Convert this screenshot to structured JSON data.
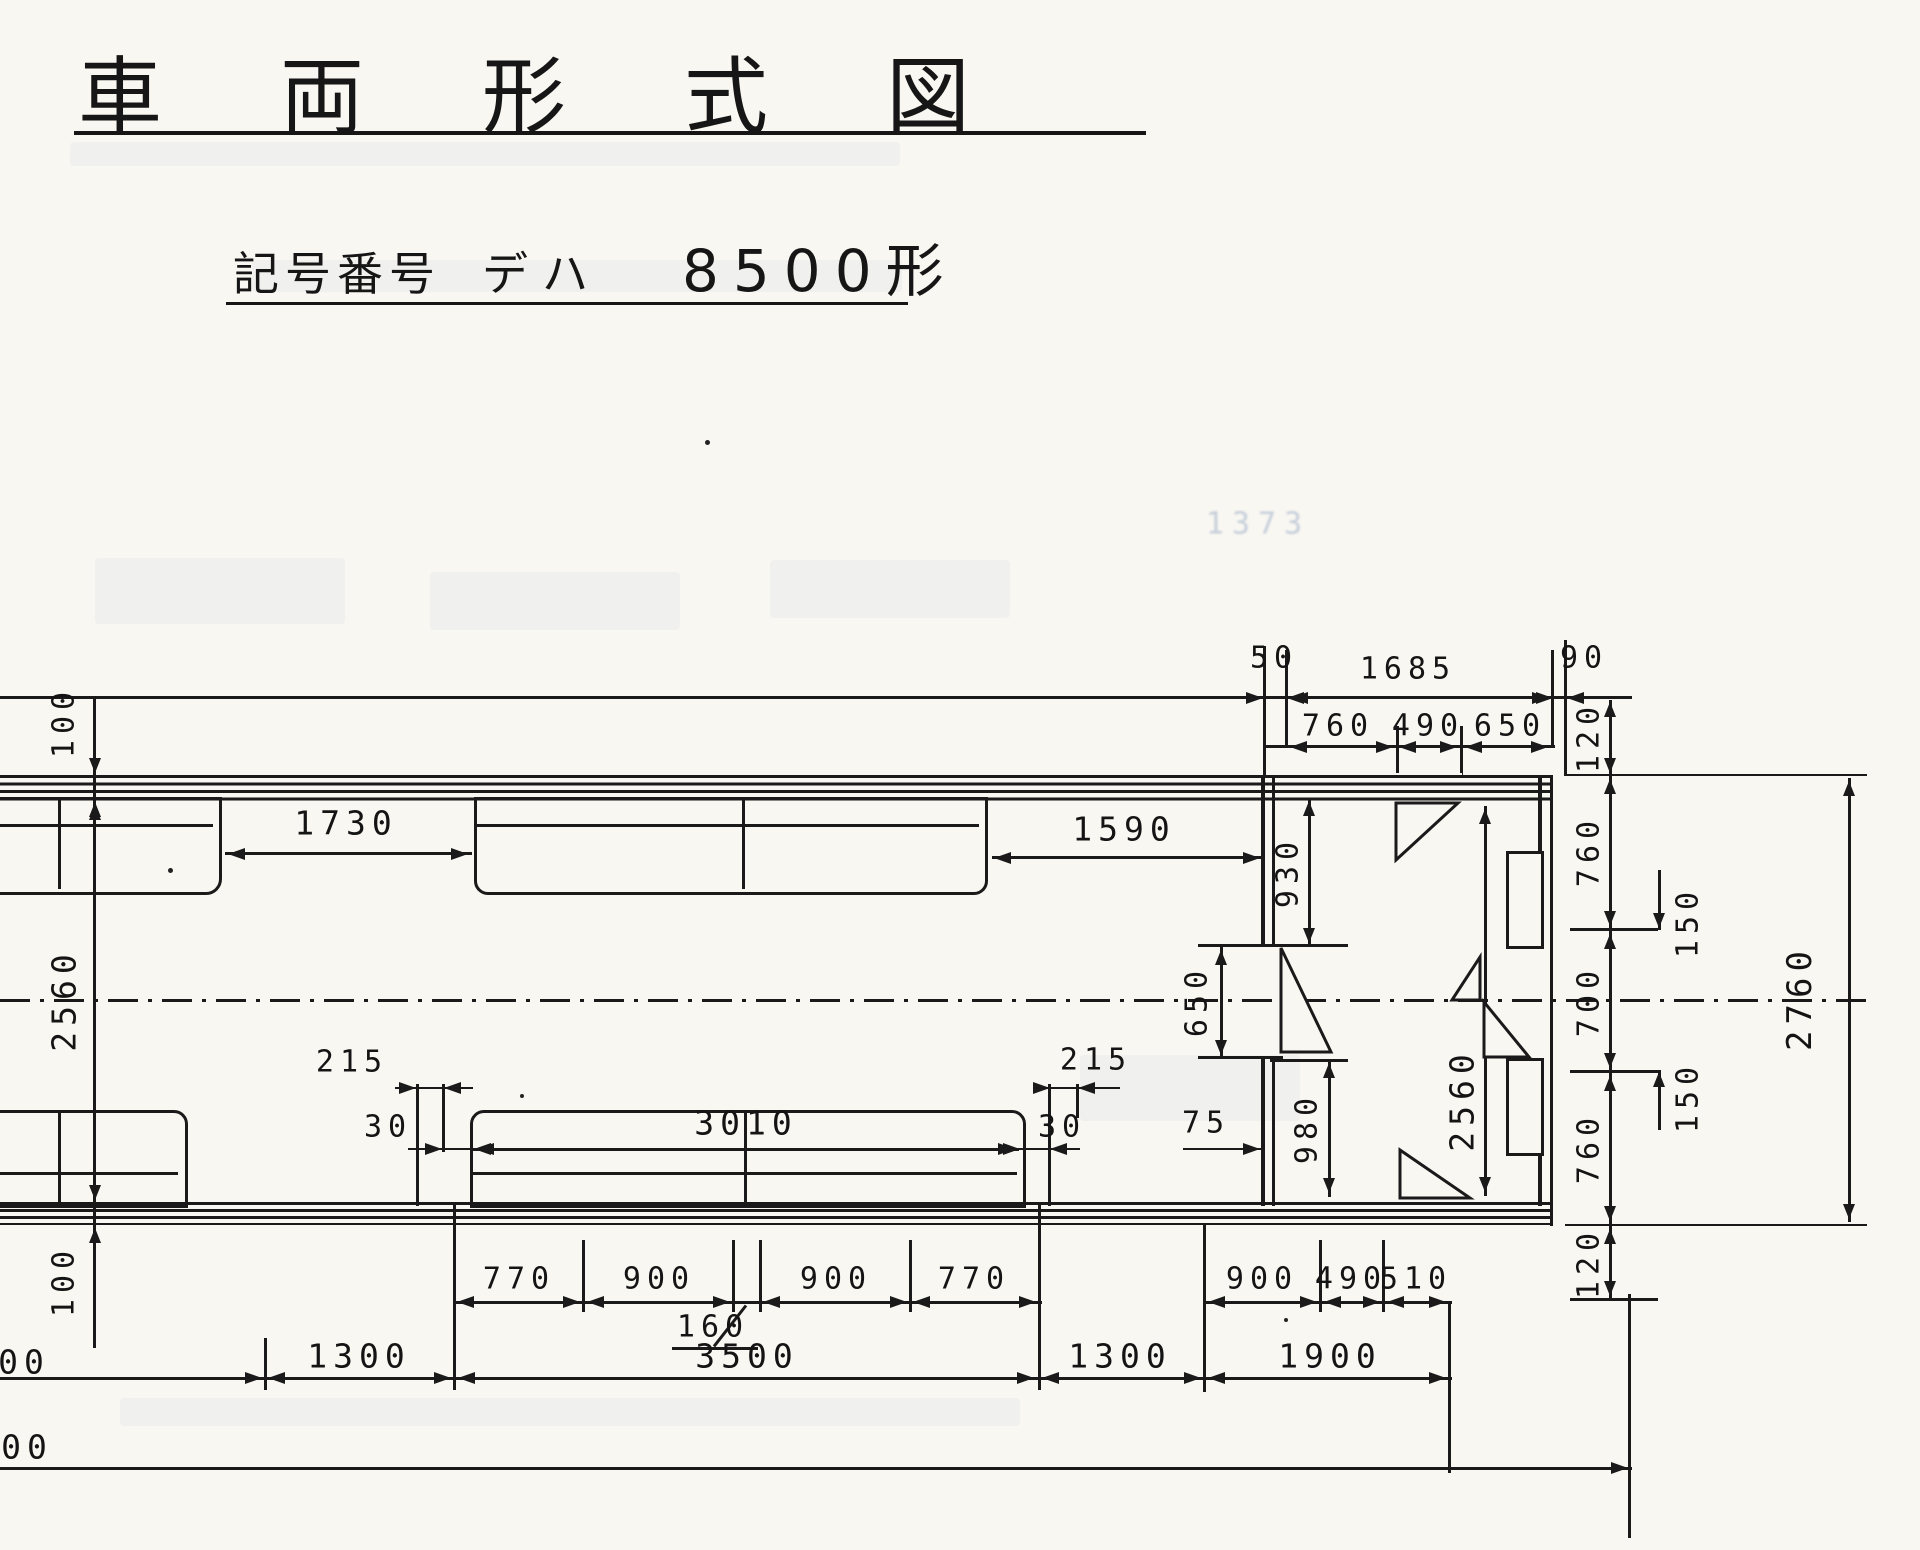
{
  "title": "車両形式図",
  "subtitle": {
    "label": "記号番号",
    "series": "デハ",
    "model": "8500形"
  },
  "dims": {
    "top_50": "50",
    "top_1685": "1685",
    "top_90": "90",
    "top_760": "760",
    "top_490": "490",
    "top_650": "650",
    "right_120_top": "120",
    "right_760_upper": "760",
    "right_700": "700",
    "right_760_lower": "760",
    "right_120_bottom": "120",
    "right_150_upper": "150",
    "right_150_lower": "150",
    "right_2760": "2760",
    "seat_gap_1730": "1730",
    "seat_gap_1590": "1590",
    "cab_930": "930",
    "cab_650": "650",
    "wall_100_top": "100",
    "body_2560_left": "2560",
    "seat_215_left": "215",
    "seat_30_left": "30",
    "seat_3010": "3010",
    "seat_30_right": "30",
    "seat_215_right": "215",
    "seat_75": "75",
    "cab_980": "980",
    "cab_2560": "2560",
    "wall_100_bottom": "100",
    "spacing_770_a": "770",
    "spacing_900_a": "900",
    "spacing_160": "160",
    "spacing_900_b": "900",
    "spacing_770_b": "770",
    "end_900": "900",
    "end_490": "490",
    "end_510": "510",
    "bottom_1300_left": "1300",
    "bottom_3500": "3500",
    "bottom_1300_right": "1300",
    "bottom_1900": "1900",
    "partial_left_upper": "00",
    "partial_left_lower": "00"
  },
  "ghosts": {
    "faint_number": "1373"
  },
  "colors": {
    "ink": "#1a1a1a",
    "paper": "#f9f7f2"
  }
}
